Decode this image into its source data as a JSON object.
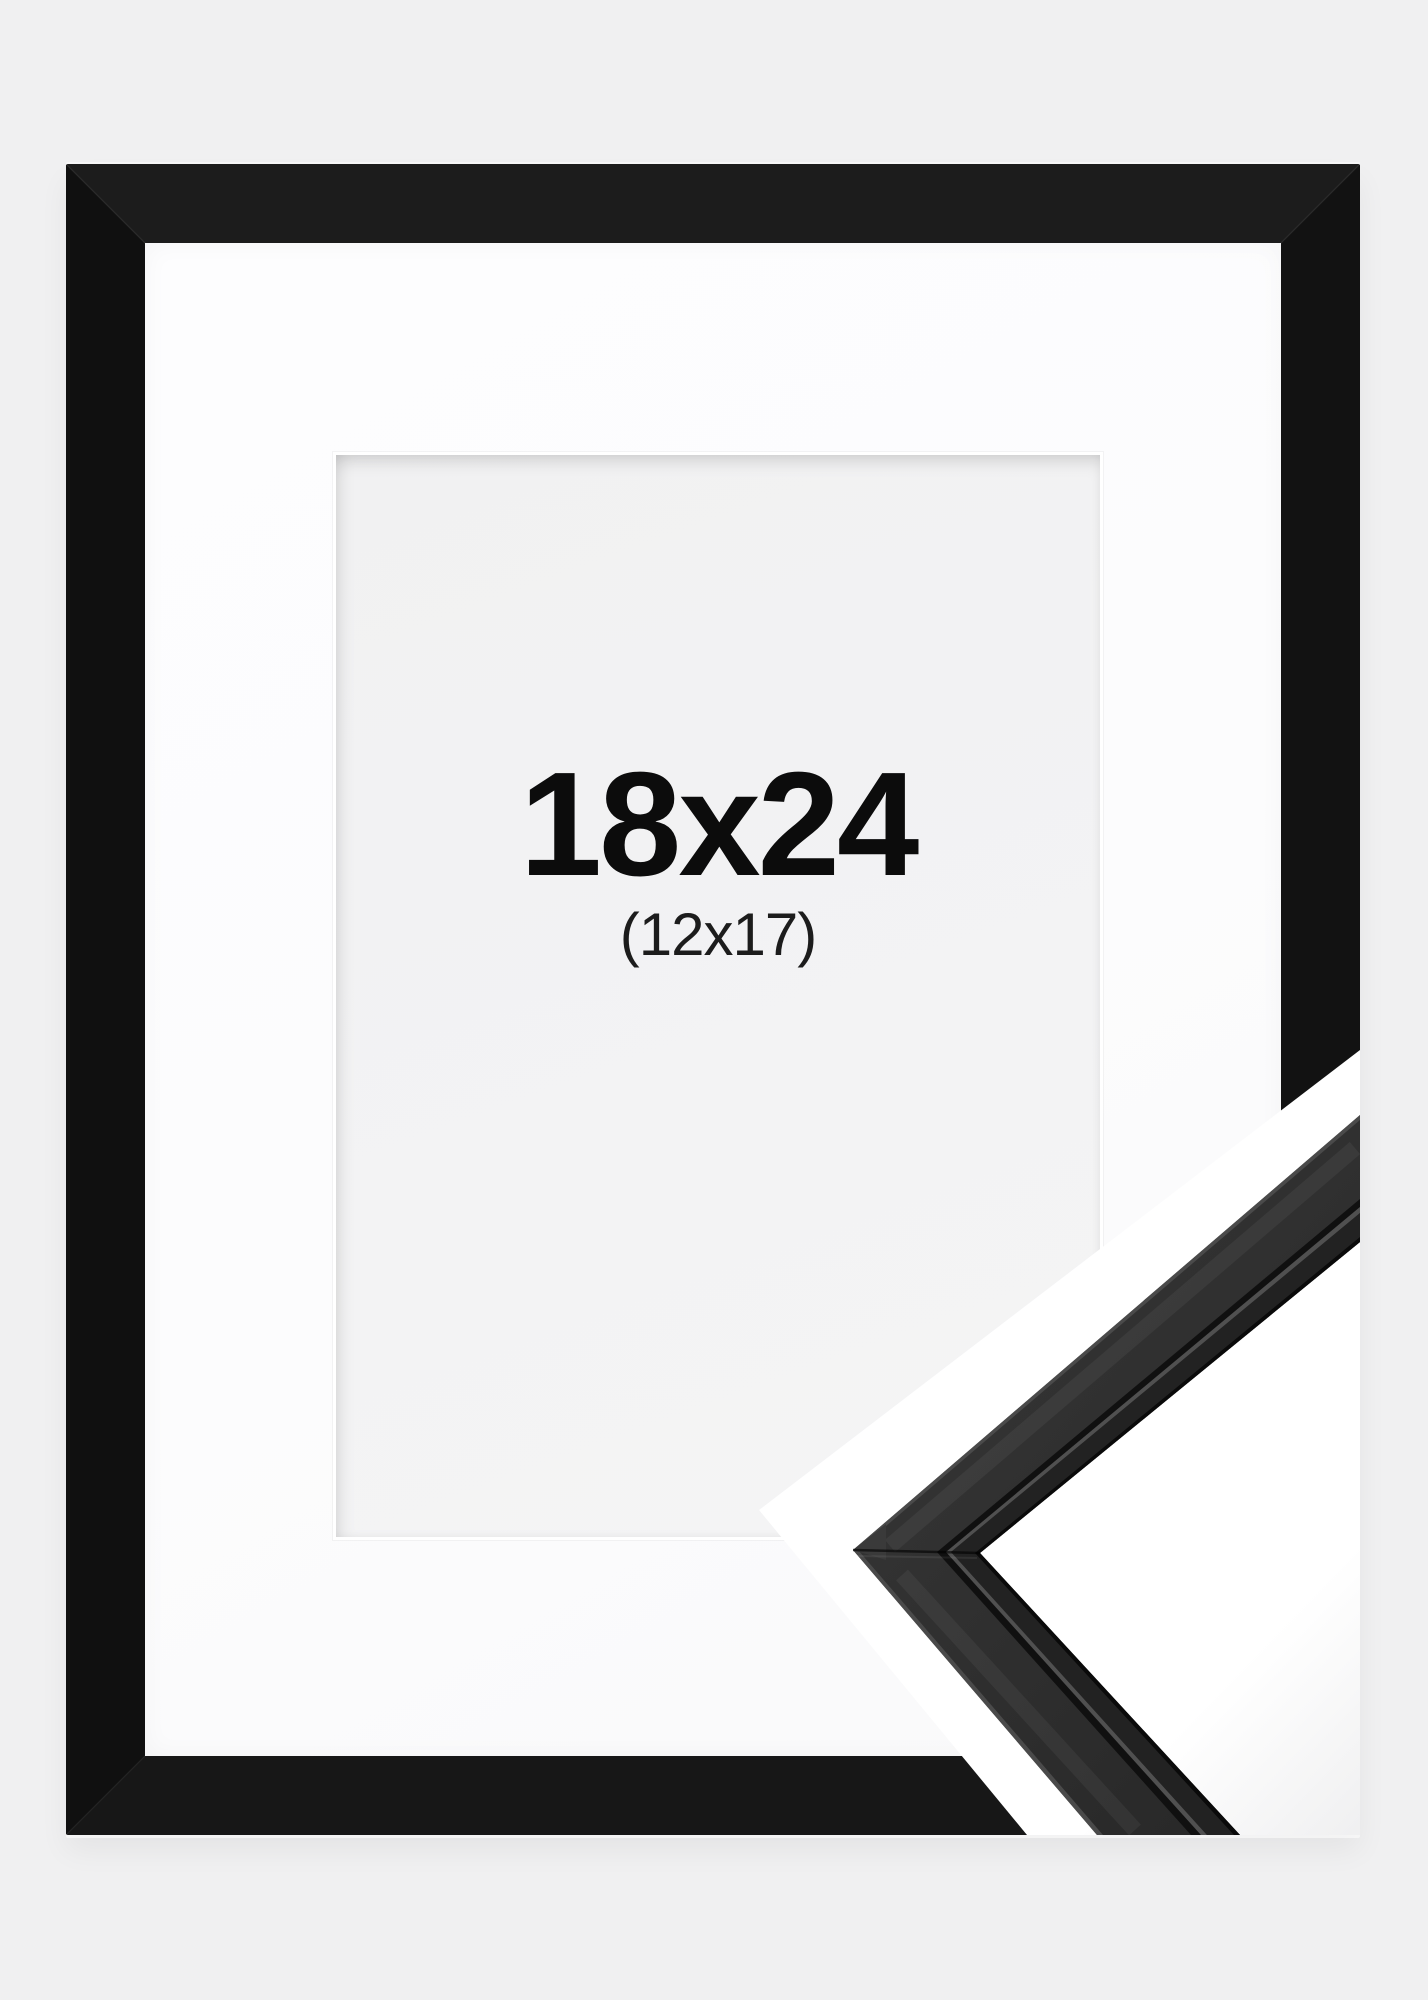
{
  "product": {
    "size_label": "18x24",
    "inner_size_label": "(12x17)"
  },
  "colors": {
    "background": "#f0f0f1",
    "frame_black": "#151515",
    "mat_white": "#fcfcfd",
    "opening_gray": "#f2f2f3",
    "text_primary": "#0c0c0c",
    "text_secondary": "#1c1c1c",
    "sample_face": "#2e2e2e",
    "sample_edge_highlight": "#4a4a4a",
    "sample_groove": "#101010",
    "sample_groove_highlight": "#505050",
    "sample_lip": "#222222",
    "sample_inner_edge": "#0a0a0a",
    "cutout_white": "#ffffff"
  }
}
